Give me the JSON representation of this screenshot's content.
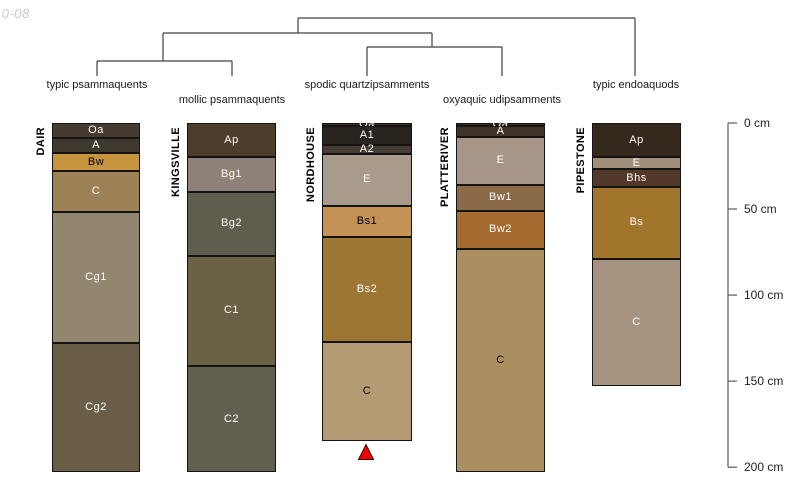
{
  "watermark": "10-08",
  "colors": {
    "background": "#ffffff",
    "dendrogram_line": "#404040",
    "axis_line": "#5a5a5a",
    "axis_text": "#1f1f1f",
    "classification_text": "#1a1a1a",
    "horizon_border": "#141414",
    "watermark_text": "#c9c9c9",
    "marker_fill": "#ee0000",
    "marker_stroke": "#3c0a0a"
  },
  "chart_data": {
    "type": "other",
    "subtype": "soil-profile-sketches-with-dendrogram",
    "title": "",
    "description": "Five soil profiles drawn as horizon stacks, grouped by a taxonomic dendrogram, depth axis 0-200 cm on the right, red triangle marker below NORDHOUSE profile",
    "depth_axis": {
      "unit": "cm",
      "range": [
        0,
        200
      ],
      "ticks": [
        {
          "depth_cm": 0,
          "label": "0 cm"
        },
        {
          "depth_cm": 50,
          "label": "50 cm"
        },
        {
          "depth_cm": 100,
          "label": "100 cm"
        },
        {
          "depth_cm": 150,
          "label": "150 cm"
        },
        {
          "depth_cm": 200,
          "label": "200 cm"
        }
      ]
    },
    "dendrogram": {
      "topology": "(((typic psammaquents, mollic psammaquents),(spodic quartzipsamments, oxyaquic udipsamments)), typic endoaquods)",
      "segments": [
        [
          298,
          18,
          635,
          18
        ],
        [
          298,
          18,
          298,
          33
        ],
        [
          635,
          18,
          635,
          76
        ],
        [
          163,
          33,
          432,
          33
        ],
        [
          163,
          33,
          163,
          61
        ],
        [
          432,
          33,
          432,
          47
        ],
        [
          97,
          61,
          232,
          61
        ],
        [
          97,
          61,
          97,
          76
        ],
        [
          232,
          61,
          232,
          76
        ],
        [
          367,
          47,
          502,
          47
        ],
        [
          367,
          47,
          367,
          76
        ],
        [
          502,
          47,
          502,
          76
        ]
      ],
      "leaf_labels": [
        {
          "text": "typic psammaquents",
          "x": 97,
          "y": 86
        },
        {
          "text": "mollic psammaquents",
          "x": 232,
          "y": 101
        },
        {
          "text": "spodic quartzipsamments",
          "x": 367,
          "y": 86
        },
        {
          "text": "oxyaquic udipsamments",
          "x": 502,
          "y": 101
        },
        {
          "text": "typic endoaquods",
          "x": 636,
          "y": 86
        }
      ]
    },
    "profiles": [
      {
        "id": "DAIR",
        "classification": "typic psammaquents",
        "horizons": [
          {
            "name": "Oa",
            "top_cm": 0,
            "bottom_cm": 9,
            "color": "#463b31",
            "label_color": "#ffffff"
          },
          {
            "name": "A",
            "top_cm": 9,
            "bottom_cm": 17.5,
            "color": "#3e382d",
            "label_color": "#ffffff"
          },
          {
            "name": "Bw",
            "top_cm": 17.5,
            "bottom_cm": 28,
            "color": "#c6933f",
            "label_color": "#000000"
          },
          {
            "name": "C",
            "top_cm": 28,
            "bottom_cm": 52,
            "color": "#9d8257",
            "label_color": "#ffffff"
          },
          {
            "name": "Cg1",
            "top_cm": 52,
            "bottom_cm": 128,
            "color": "#92866e",
            "label_color": "#ffffff"
          },
          {
            "name": "Cg2",
            "top_cm": 128,
            "bottom_cm": 203,
            "color": "#6a5e47",
            "label_color": "#ffffff"
          }
        ]
      },
      {
        "id": "KINGSVILLE",
        "classification": "mollic psammaquents",
        "horizons": [
          {
            "name": "Ap",
            "top_cm": 0,
            "bottom_cm": 20,
            "color": "#4e3d2a",
            "label_color": "#ffffff"
          },
          {
            "name": "Bg1",
            "top_cm": 20,
            "bottom_cm": 40,
            "color": "#8e8177",
            "label_color": "#ffffff"
          },
          {
            "name": "Bg2",
            "top_cm": 40,
            "bottom_cm": 77,
            "color": "#5f5d4d",
            "label_color": "#ffffff"
          },
          {
            "name": "C1",
            "top_cm": 77,
            "bottom_cm": 141,
            "color": "#6a6245",
            "label_color": "#ffffff"
          },
          {
            "name": "C2",
            "top_cm": 141,
            "bottom_cm": 203,
            "color": "#625f50",
            "label_color": "#ffffff"
          }
        ]
      },
      {
        "id": "NORDHOUSE",
        "classification": "spodic quartzipsamments",
        "horizons": [
          {
            "name": "Oa",
            "top_cm": 0,
            "bottom_cm": 2,
            "color": "#3a322a",
            "label_color": "#ffffff"
          },
          {
            "name": "A1",
            "top_cm": 2,
            "bottom_cm": 13,
            "color": "#2a241e",
            "label_color": "#ffffff"
          },
          {
            "name": "A2",
            "top_cm": 13,
            "bottom_cm": 18,
            "color": "#463c33",
            "label_color": "#ffffff"
          },
          {
            "name": "E",
            "top_cm": 18,
            "bottom_cm": 48,
            "color": "#a99b8c",
            "label_color": "#ffffff"
          },
          {
            "name": "Bs1",
            "top_cm": 48,
            "bottom_cm": 66,
            "color": "#c49254",
            "label_color": "#000000"
          },
          {
            "name": "Bs2",
            "top_cm": 66,
            "bottom_cm": 127,
            "color": "#9d7633",
            "label_color": "#ffffff"
          },
          {
            "name": "C",
            "top_cm": 127,
            "bottom_cm": 185,
            "color": "#b49b73",
            "label_color": "#000000"
          }
        ]
      },
      {
        "id": "PLATTERIVER",
        "classification": "oxyaquic udipsamments",
        "horizons": [
          {
            "name": "Oa",
            "top_cm": 0,
            "bottom_cm": 2,
            "color": "#2d2925",
            "label_color": "#ffffff"
          },
          {
            "name": "A",
            "top_cm": 2,
            "bottom_cm": 8,
            "color": "#3e342b",
            "label_color": "#ffffff"
          },
          {
            "name": "E",
            "top_cm": 8,
            "bottom_cm": 36,
            "color": "#a79688",
            "label_color": "#ffffff"
          },
          {
            "name": "Bw1",
            "top_cm": 36,
            "bottom_cm": 51,
            "color": "#8a6a49",
            "label_color": "#ffffff"
          },
          {
            "name": "Bw2",
            "top_cm": 51,
            "bottom_cm": 73,
            "color": "#a56a2e",
            "label_color": "#ffffff"
          },
          {
            "name": "C",
            "top_cm": 73,
            "bottom_cm": 203,
            "color": "#ab8f60",
            "label_color": "#000000"
          }
        ]
      },
      {
        "id": "PIPESTONE",
        "classification": "typic endoaquods",
        "horizons": [
          {
            "name": "Ap",
            "top_cm": 0,
            "bottom_cm": 20,
            "color": "#35291d",
            "label_color": "#ffffff"
          },
          {
            "name": "E",
            "top_cm": 20,
            "bottom_cm": 27,
            "color": "#a28f7a",
            "label_color": "#ffffff"
          },
          {
            "name": "Bhs",
            "top_cm": 27,
            "bottom_cm": 37,
            "color": "#523829",
            "label_color": "#ffffff"
          },
          {
            "name": "Bs",
            "top_cm": 37,
            "bottom_cm": 79,
            "color": "#a1762c",
            "label_color": "#ffffff"
          },
          {
            "name": "C",
            "top_cm": 79,
            "bottom_cm": 153,
            "color": "#a5937f",
            "label_color": "#ffffff"
          }
        ]
      }
    ],
    "marker": {
      "type": "triangle-up",
      "below_profile": "NORDHOUSE",
      "color": "#ee0000"
    }
  },
  "geometry": {
    "axis": {
      "x": 728,
      "top": 123,
      "px_per_cm": 1.721,
      "tick_len": 9,
      "label_offset": 16
    },
    "profiles": [
      {
        "left": 52,
        "width": 88
      },
      {
        "left": 187,
        "width": 89
      },
      {
        "left": 322,
        "width": 90
      },
      {
        "left": 456,
        "width": 89
      },
      {
        "left": 592,
        "width": 89
      }
    ],
    "title_offset": 17,
    "marker": {
      "cx": 366,
      "apex_y": 444.5,
      "half_w": 7.5,
      "h": 15
    }
  }
}
